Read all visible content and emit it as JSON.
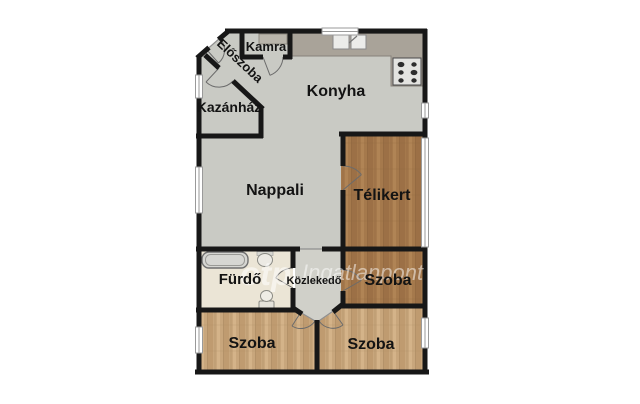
{
  "floorplan": {
    "type": "apartment-floor-plan",
    "rooms": {
      "kamra": {
        "label": "Kamra"
      },
      "eloszoba": {
        "label": "Előszoba"
      },
      "kazanhaz": {
        "label": "Kazánház"
      },
      "konyha": {
        "label": "Konyha"
      },
      "nappali": {
        "label": "Nappali"
      },
      "telikert": {
        "label": "Télikert"
      },
      "furdo": {
        "label": "Fürdő"
      },
      "kozlekedo": {
        "label": "Közlekedő"
      },
      "szoba_right": {
        "label": "Szoba"
      },
      "szoba_bottom_left": {
        "label": "Szoba"
      },
      "szoba_bottom_right": {
        "label": "Szoba"
      }
    },
    "fixtures": [
      "kitchen-counter",
      "kitchen-sink",
      "stove",
      "pantry-shelf",
      "bathtub",
      "washbasin",
      "toilet",
      "door-swing",
      "window"
    ],
    "watermark": {
      "logo": "otp",
      "brand": "Ingatlanpont"
    },
    "colors": {
      "background": "#ffffff",
      "wall": "#171717",
      "floor_gray": "#c9cac4",
      "floor_corridor": "#d0d0c9",
      "floor_bath": "#ebe5d6",
      "floor_wood_dark": "#a5794c",
      "floor_wood_light": "#c8a67c",
      "counter": "#a9a399",
      "watermark_color": "rgba(255,255,255,0.55)"
    }
  }
}
